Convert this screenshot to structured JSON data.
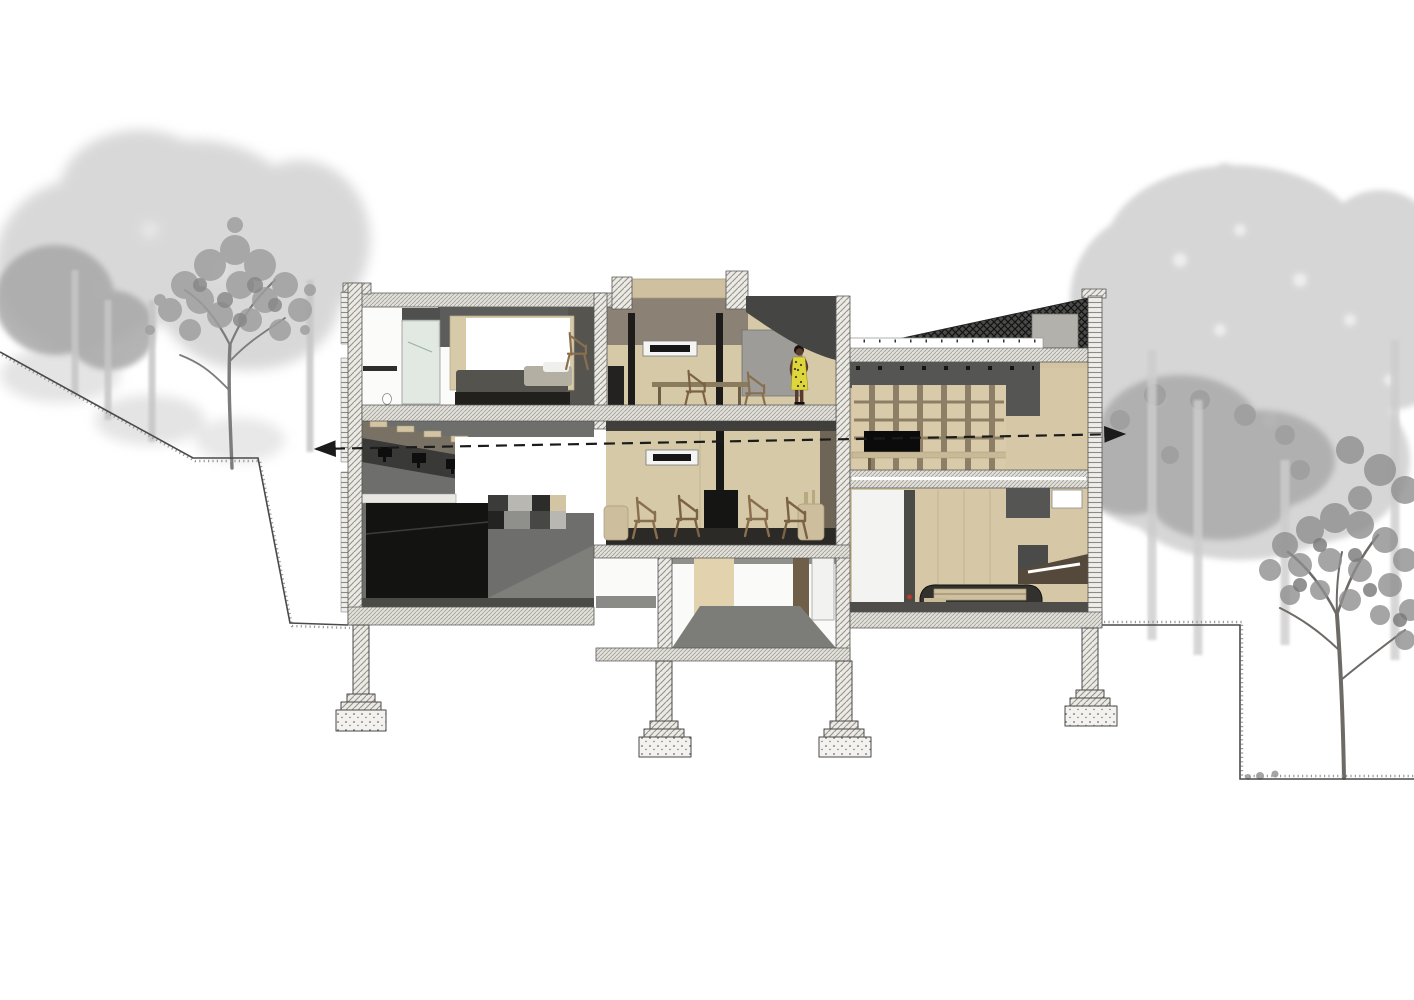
{
  "drawing": {
    "type": "architectural-section",
    "subject": "two-storey hillside house cross-section with site trees",
    "annotation": {
      "section_cut_line": "horizontal dashed line with arrowheads at both ends"
    }
  },
  "colors": {
    "canvas": "#ffffff",
    "line": "#1b1b1b",
    "terrain_line": "#4a4a4a",
    "wood_light": "#d6c9a8",
    "wood_mid": "#d2c4a2",
    "wood_step": "#d3c5a3",
    "taupe": "#8b8174",
    "brown_dark": "#55493b",
    "gray_wall": "#555553",
    "gray_mid": "#6e6e6c",
    "gray_floor": "#4e4d4a",
    "charcoal": "#0b0b0b",
    "cabinet_black": "#131312",
    "concrete_bg": "#eceae5",
    "slab_bg": "#e3e1db",
    "glass": "#dfe8e0",
    "dress_yellow": "#ded63a",
    "skin": "#5a3a2c",
    "accent_red": "#c03a2b",
    "tree_soft": "#d4d4d4",
    "tree_light": "#c6c6c6",
    "tree_mid": "#a7a7a7",
    "tree_dark": "#8f8f8f",
    "trunk": "#7c7c7c"
  },
  "site": {
    "left_terrain": "slope descending from upper left to building base",
    "right_terrain": "flat bench stepping down to lower grade at right",
    "vegetation": "gray tree silhouettes behind and beside the house"
  },
  "building": {
    "levels": [
      "upper-floor",
      "main-floor",
      "basement",
      "pier-foundations"
    ],
    "rooms": [
      {
        "name": "bathroom-shower"
      },
      {
        "name": "bedroom"
      },
      {
        "name": "study"
      },
      {
        "name": "stair-over-kitchen"
      },
      {
        "name": "living-room"
      },
      {
        "name": "double-height-hall"
      },
      {
        "name": "basement-corridor"
      },
      {
        "name": "garage"
      }
    ],
    "furniture": [
      "bed",
      "shower-screen",
      "desk-chairs",
      "lounge-chairs",
      "wood-stove",
      "tv",
      "shelving-grid",
      "long-counter",
      "kitchen-cabinets",
      "monitors",
      "car"
    ],
    "occupant": "standing figure in yellow patterned dress"
  }
}
